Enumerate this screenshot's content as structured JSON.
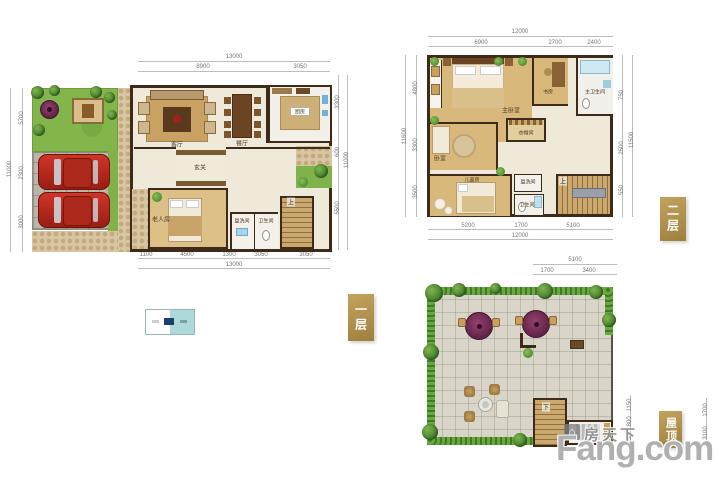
{
  "brand": {
    "cn": "房天下",
    "en": "Fang.com",
    "logo_glyph": "⌂"
  },
  "tags": {
    "floor1": "一层",
    "floor2": "二层",
    "roof": "屋顶"
  },
  "colors": {
    "tag_gold": "#b3924d",
    "legend_teal": "#aed9da",
    "legend_navy": "#1d3f6f",
    "car_red": "#b3281c",
    "umbrella_purple": "#7d3261",
    "grass_green": "#83b64a",
    "wood_floor_tan": "#d9b87c",
    "wall_brown": "#3d2a18"
  },
  "floor1": {
    "rooms": {
      "living": "客厅",
      "dining": "餐厅",
      "kitchen": "厨房",
      "foyer": "玄关",
      "elder_room": "老人房",
      "washroom": "盥洗间",
      "bathroom": "卫生间",
      "stairs": "上"
    },
    "dims": {
      "top": {
        "total": "13000",
        "segments": [
          "8900",
          "3050"
        ]
      },
      "bottom": {
        "total": "13000",
        "segments": [
          "1100",
          "4500",
          "1300",
          "3050",
          "3050"
        ]
      },
      "left": {
        "total": "11000",
        "segments": [
          "5700",
          "2300",
          "3000"
        ]
      },
      "right": {
        "total": "11000",
        "segments": [
          "3300",
          "600",
          "5500"
        ]
      }
    }
  },
  "floor2": {
    "rooms": {
      "master": "主卧室",
      "study": "书房",
      "master_bath": "主卫生间",
      "closet": "衣帽间",
      "bedroom": "卧室",
      "kids": "儿童房",
      "washroom": "盥洗间",
      "bathroom": "卫生间",
      "stairs": "上"
    },
    "dims": {
      "top": {
        "total": "12000",
        "segments": [
          "6900",
          "2700",
          "2400"
        ]
      },
      "bottom": {
        "total": "12000",
        "segments": [
          "5200",
          "1700",
          "5100"
        ]
      },
      "left": {
        "total": "11600",
        "segments": [
          "4800",
          "3300",
          "3500"
        ]
      },
      "right": {
        "total": "11500",
        "segments": [
          "750",
          "2500",
          "550"
        ]
      }
    }
  },
  "roof": {
    "rooms": {
      "stairs": "下"
    },
    "dims": {
      "top": {
        "total": "5100",
        "segments": [
          "1700",
          "3400"
        ]
      },
      "right_inner": {
        "segments": [
          "1150",
          "1800",
          "450"
        ]
      },
      "right_outer": {
        "segments": [
          "1700",
          "3100"
        ]
      }
    }
  }
}
